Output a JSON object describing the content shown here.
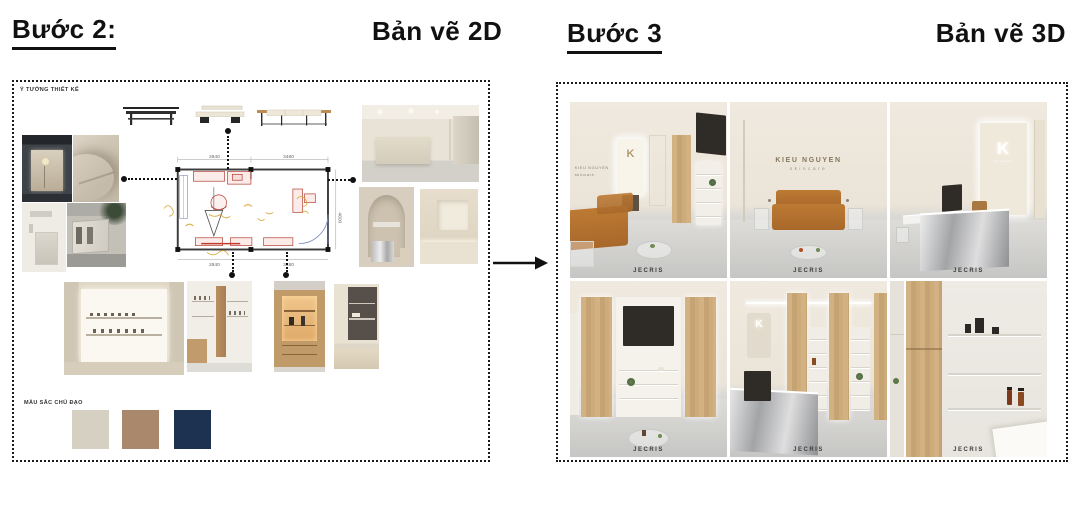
{
  "header": {
    "step2_label": "Bước 2:",
    "step2_title": "Bản vẽ 2D",
    "step3_label": "Bước 3",
    "step3_title": "Bản vẽ 3D"
  },
  "panel_2d": {
    "concept_label": "Ý TƯỞNG THIẾT KẾ",
    "palette_label": "MÀU SẮC CHỦ ĐẠO",
    "palette": [
      "#d6d0c3",
      "#a9886c",
      "#1d3150"
    ],
    "floor_plan": {
      "dim_top_left": "2840",
      "dim_top_right": "3480",
      "dim_bottom_left": "2840",
      "dim_bottom_right": "3480",
      "dim_right": "4600"
    }
  },
  "panel_3d": {
    "brand_name": "KIEU NGUYEN",
    "brand_sub": "skincare",
    "logo_letter": "K",
    "watermark": "JECRIS"
  }
}
